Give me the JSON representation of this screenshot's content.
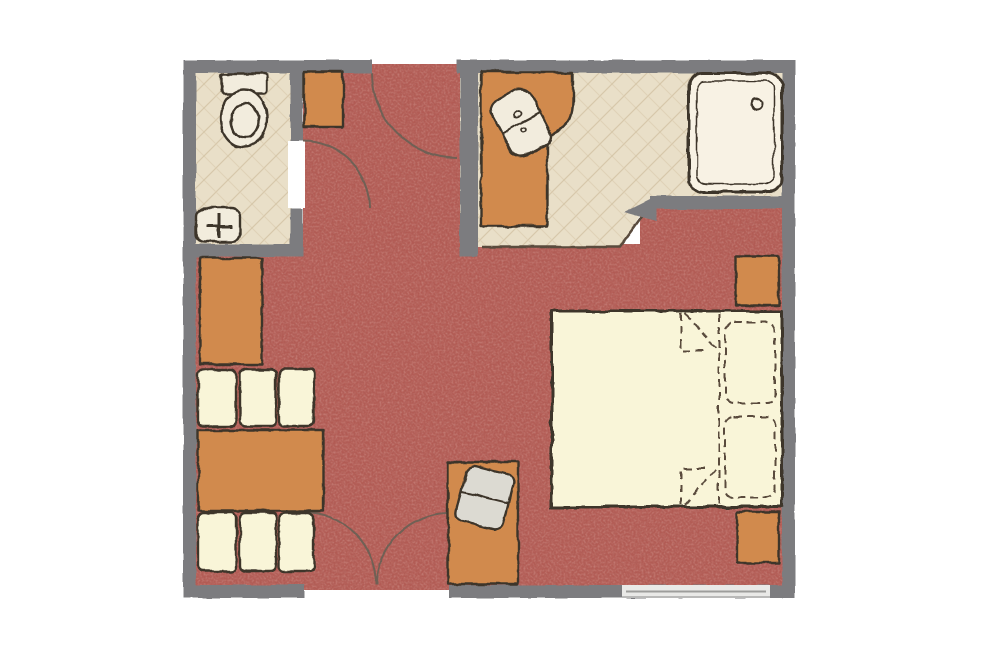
{
  "page": {
    "title": "Hotel room floor plan"
  },
  "colors": {
    "background": "#ffffff",
    "wall": "#7c7c7f",
    "carpet": "#b25b54",
    "tile": "#e9dfc8",
    "tile_line": "#d2c2a2",
    "outline": "#3e352a",
    "sketch_soft": "#5a4c3e",
    "cream": "#f9f5d8",
    "orange": "#d18a4d",
    "fixture": "#f2ecdd",
    "shower_tray": "#f8f2e4",
    "chair": "#dcdad2",
    "window": "#e9e9e7",
    "window_line": "#9d9d9b",
    "arc": "#6f6054"
  },
  "plan": {
    "rooms": [
      {
        "id": "bathroom-wc",
        "floor": "tile",
        "fixtures": [
          "toilet",
          "hand-sink"
        ]
      },
      {
        "id": "shower-room",
        "floor": "tile",
        "fixtures": [
          "vanity-counter",
          "vanity-sink",
          "shower-tray"
        ]
      },
      {
        "id": "hallway",
        "floor": "carpet",
        "fixtures": [
          "hall-cabinet"
        ]
      },
      {
        "id": "main-room",
        "floor": "carpet",
        "fixtures": [
          "wardrobe",
          "sofa-top",
          "coffee-table",
          "sofa-bottom",
          "desk",
          "desk-chair",
          "double-bed",
          "nightstand-top",
          "nightstand-bottom"
        ]
      }
    ],
    "doors": [
      "entrance-door-top",
      "wc-door",
      "double-door-bottom"
    ],
    "windows": [
      "bottom-wall-window"
    ]
  }
}
